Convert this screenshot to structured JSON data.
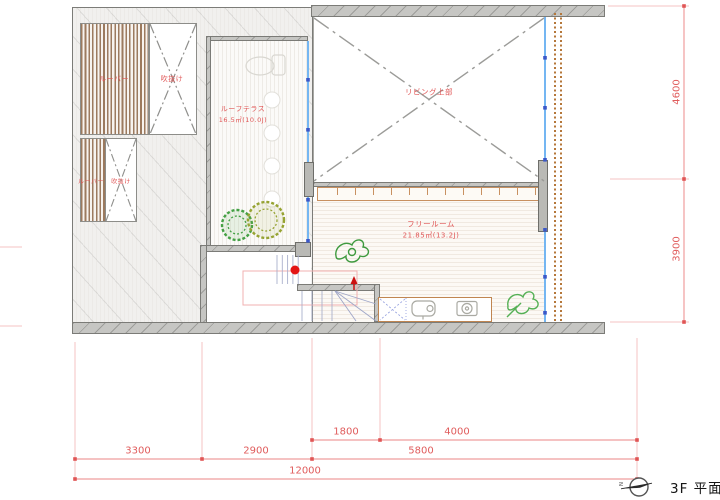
{
  "plan": {
    "labels": {
      "louver1": "ルーバー",
      "void1": "吹抜け",
      "louver2": "ルーバー",
      "void2": "吹抜け",
      "terrace_name": "ルーフテラス",
      "terrace_area": "16.5㎡(10.0J)",
      "living": "リビング上部",
      "freeroom_name": "フリールーム",
      "freeroom_area": "21.85㎡(13.2J)"
    }
  },
  "dimensions": {
    "bottom_level1": [
      {
        "label": "1800"
      },
      {
        "label": "4000"
      }
    ],
    "bottom_level2": [
      {
        "label": "3300"
      },
      {
        "label": "2900"
      },
      {
        "label": "5800"
      }
    ],
    "bottom_total": "12000",
    "right": [
      {
        "label": "4600"
      },
      {
        "label": "3900"
      }
    ]
  },
  "compass": {
    "north": "N"
  },
  "title_block": {
    "drawing_title": "3F 平面図"
  },
  "colors": {
    "label_red": "#e05555",
    "dimension_red": "#e05c5c",
    "window_blue": "#74b6f2",
    "louver_brown": "#9c7a5e",
    "deck_orange": "#c89060",
    "wall_gray": "#c6c6c3",
    "plant_green": "#44a044",
    "plant_olive": "#96a332"
  }
}
